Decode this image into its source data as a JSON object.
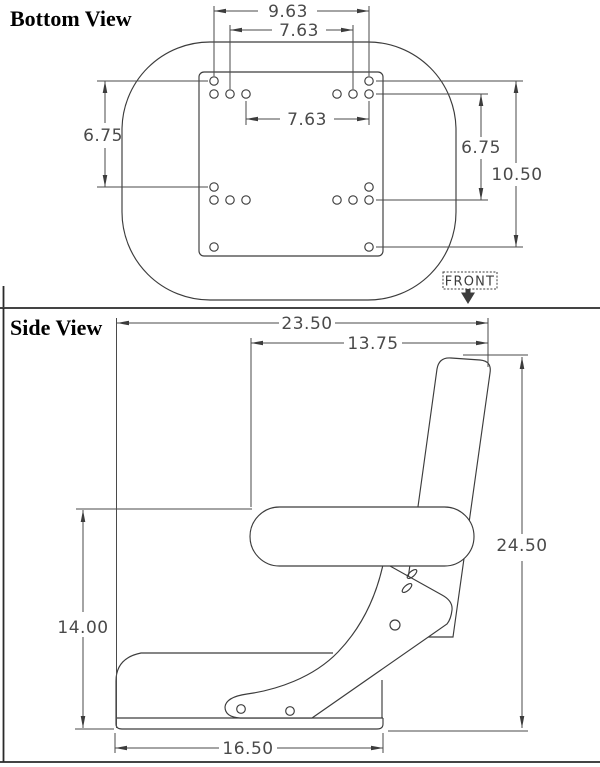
{
  "colors": {
    "ink": "#3c3c3c",
    "dimension": "#4a4a4a",
    "background": "#ffffff",
    "title": "#000000"
  },
  "bottom_view": {
    "title": "Bottom View",
    "front_label": "FRONT",
    "dimensions": {
      "mount_width_outer": "9.63",
      "mount_width_inner": "7.63",
      "mount_width_middle": "7.63",
      "mount_depth_left": "6.75",
      "mount_depth_right": "6.75",
      "mount_depth_total": "10.50"
    }
  },
  "side_view": {
    "title": "Side View",
    "dimensions": {
      "overall_depth": "23.50",
      "backrest_top_depth": "13.75",
      "overall_height": "24.50",
      "armrest_height": "14.00",
      "base_depth": "16.50"
    }
  }
}
